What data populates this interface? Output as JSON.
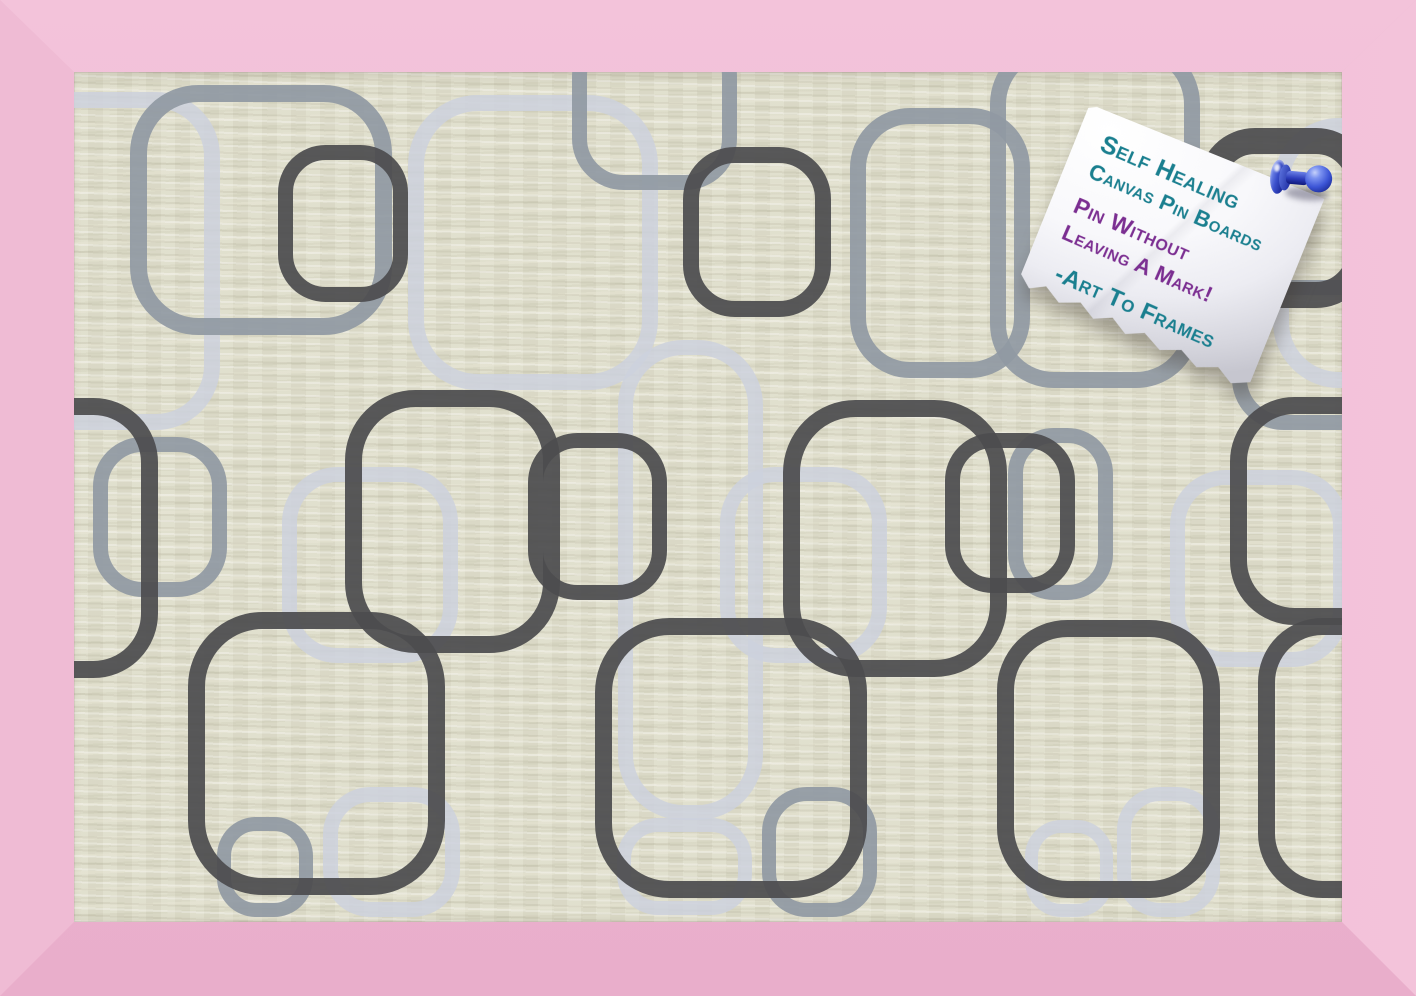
{
  "colors": {
    "frame_pink": "#eeb8d2",
    "frame_pink_light": "#f3c3da",
    "frame_pink_side": "#efbbd4",
    "frame_pink_dark": "#e9aecb",
    "canvas_beige": "#dfdecb",
    "pattern_dark": "#4c4c4f",
    "pattern_medium": "#9099a3",
    "pattern_light": "#ccd1dd",
    "note_paper": "#f8f8fb",
    "teal_ink": "#1a7f8f",
    "purple_ink": "#7b2e91",
    "pin_blue": "#2a3cb8"
  },
  "note": {
    "lines": [
      {
        "text": "Self Healing",
        "ink": "teal"
      },
      {
        "text": "Canvas Pin Boards",
        "ink": "teal"
      },
      {
        "text": "Pin Without",
        "ink": "purple"
      },
      {
        "text": "Leaving A Mark!",
        "ink": "purple"
      },
      {
        "text": "-Art To Frames",
        "ink": "teal"
      }
    ]
  },
  "pin": {
    "name": "blue-pushpin"
  },
  "board": {
    "pattern": {
      "opacity": {
        "light": 0.85,
        "medium": 0.92,
        "dark": 0.93
      },
      "squares_format": [
        "x",
        "y",
        "width",
        "height",
        "corner_radius",
        "stroke_width"
      ],
      "light": [
        [
          -134,
          20,
          280,
          338,
          56,
          16
        ],
        [
          334,
          23,
          250,
          295,
          62,
          16
        ],
        [
          1199,
          46,
          220,
          270,
          58,
          16
        ],
        [
          208,
          395,
          176,
          196,
          48,
          15
        ],
        [
          646,
          395,
          167,
          196,
          48,
          15
        ],
        [
          544,
          268,
          145,
          480,
          58,
          15
        ],
        [
          249,
          715,
          137,
          130,
          40,
          15
        ],
        [
          543,
          746,
          135,
          97,
          34,
          14
        ],
        [
          951,
          748,
          88,
          97,
          30,
          13
        ],
        [
          1043,
          715,
          103,
          130,
          36,
          14
        ],
        [
          1096,
          398,
          178,
          197,
          48,
          15
        ]
      ],
      "medium": [
        [
          56,
          13,
          262,
          250,
          60,
          17
        ],
        [
          498,
          -47,
          165,
          165,
          44,
          15
        ],
        [
          776,
          36,
          180,
          270,
          52,
          16
        ],
        [
          916,
          -32,
          210,
          348,
          56,
          16
        ],
        [
          19,
          365,
          134,
          160,
          42,
          15
        ],
        [
          934,
          356,
          105,
          172,
          38,
          15
        ],
        [
          143,
          745,
          96,
          100,
          32,
          14
        ],
        [
          688,
          715,
          115,
          130,
          38,
          14
        ],
        [
          1158,
          208,
          160,
          150,
          44,
          15
        ]
      ],
      "dark": [
        [
          204,
          73,
          130,
          157,
          40,
          15
        ],
        [
          609,
          75,
          148,
          170,
          44,
          16
        ],
        [
          1124,
          56,
          175,
          180,
          44,
          26
        ],
        [
          -169,
          326,
          253,
          280,
          56,
          17
        ],
        [
          271,
          318,
          215,
          263,
          62,
          17
        ],
        [
          454,
          361,
          139,
          167,
          42,
          15
        ],
        [
          709,
          328,
          224,
          277,
          64,
          17
        ],
        [
          871,
          361,
          130,
          160,
          40,
          15
        ],
        [
          1156,
          325,
          260,
          228,
          56,
          17
        ],
        [
          114,
          540,
          257,
          283,
          66,
          17
        ],
        [
          521,
          546,
          272,
          280,
          66,
          17
        ],
        [
          923,
          548,
          223,
          278,
          62,
          17
        ],
        [
          1184,
          546,
          190,
          280,
          56,
          17
        ]
      ]
    }
  }
}
